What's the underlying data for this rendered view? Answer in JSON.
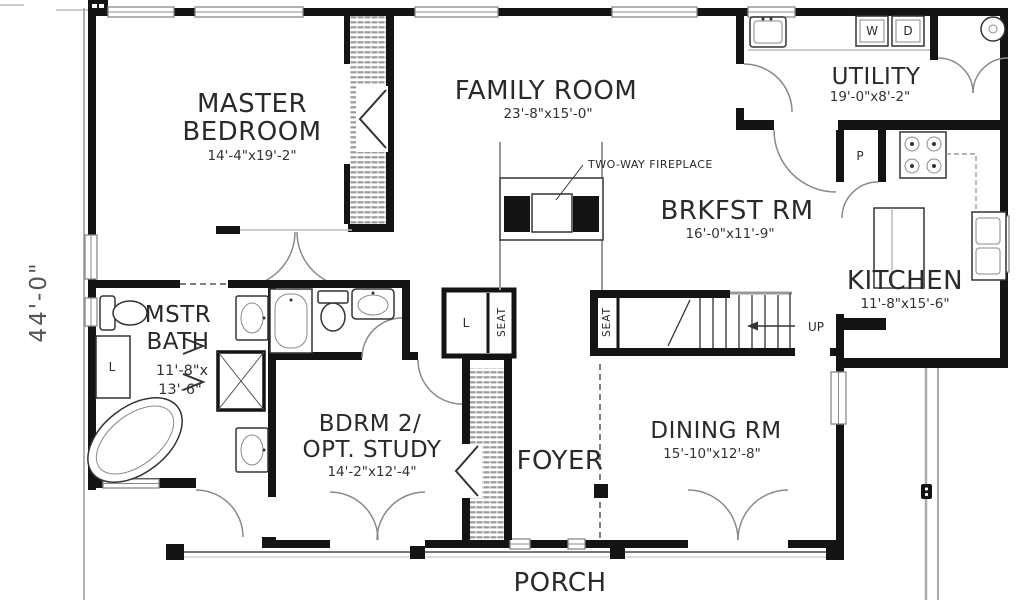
{
  "rooms": {
    "master_bedroom": {
      "line1": "MASTER",
      "line2": "BEDROOM",
      "dims": "14'-4\"x19'-2\""
    },
    "family_room": {
      "line1": "FAMILY ROOM",
      "dims": "23'-8\"x15'-0\""
    },
    "utility": {
      "line1": "UTILITY",
      "dims": "19'-0\"x8'-2\""
    },
    "brkfst": {
      "line1": "BRKFST RM",
      "dims": "16'-0\"x11'-9\""
    },
    "kitchen": {
      "line1": "KITCHEN",
      "dims": "11'-8\"x15'-6\""
    },
    "mstr_bath": {
      "line1": "MSTR",
      "line2": "BATH",
      "dims1": "11'-8\"x",
      "dims2": "13'-6\""
    },
    "bdrm2": {
      "line1": "BDRM 2/",
      "line2": "OPT. STUDY",
      "dims": "14'-2\"x12'-4\""
    },
    "foyer": {
      "line1": "FOYER"
    },
    "dining": {
      "line1": "DINING RM",
      "dims": "15'-10\"x12'-8\""
    },
    "porch": {
      "line1": "PORCH"
    }
  },
  "annotations": {
    "fireplace": "TWO-WAY FIREPLACE",
    "up": "UP",
    "seat": "SEAT",
    "linen": "L",
    "washer": "W",
    "dryer": "D",
    "pantry": "P",
    "height_dim": "44'-0\""
  },
  "colors": {
    "wall": "#141414",
    "window_line": "#8a8a8a",
    "text": "#2a2a2a",
    "dim_text": "#555555"
  }
}
